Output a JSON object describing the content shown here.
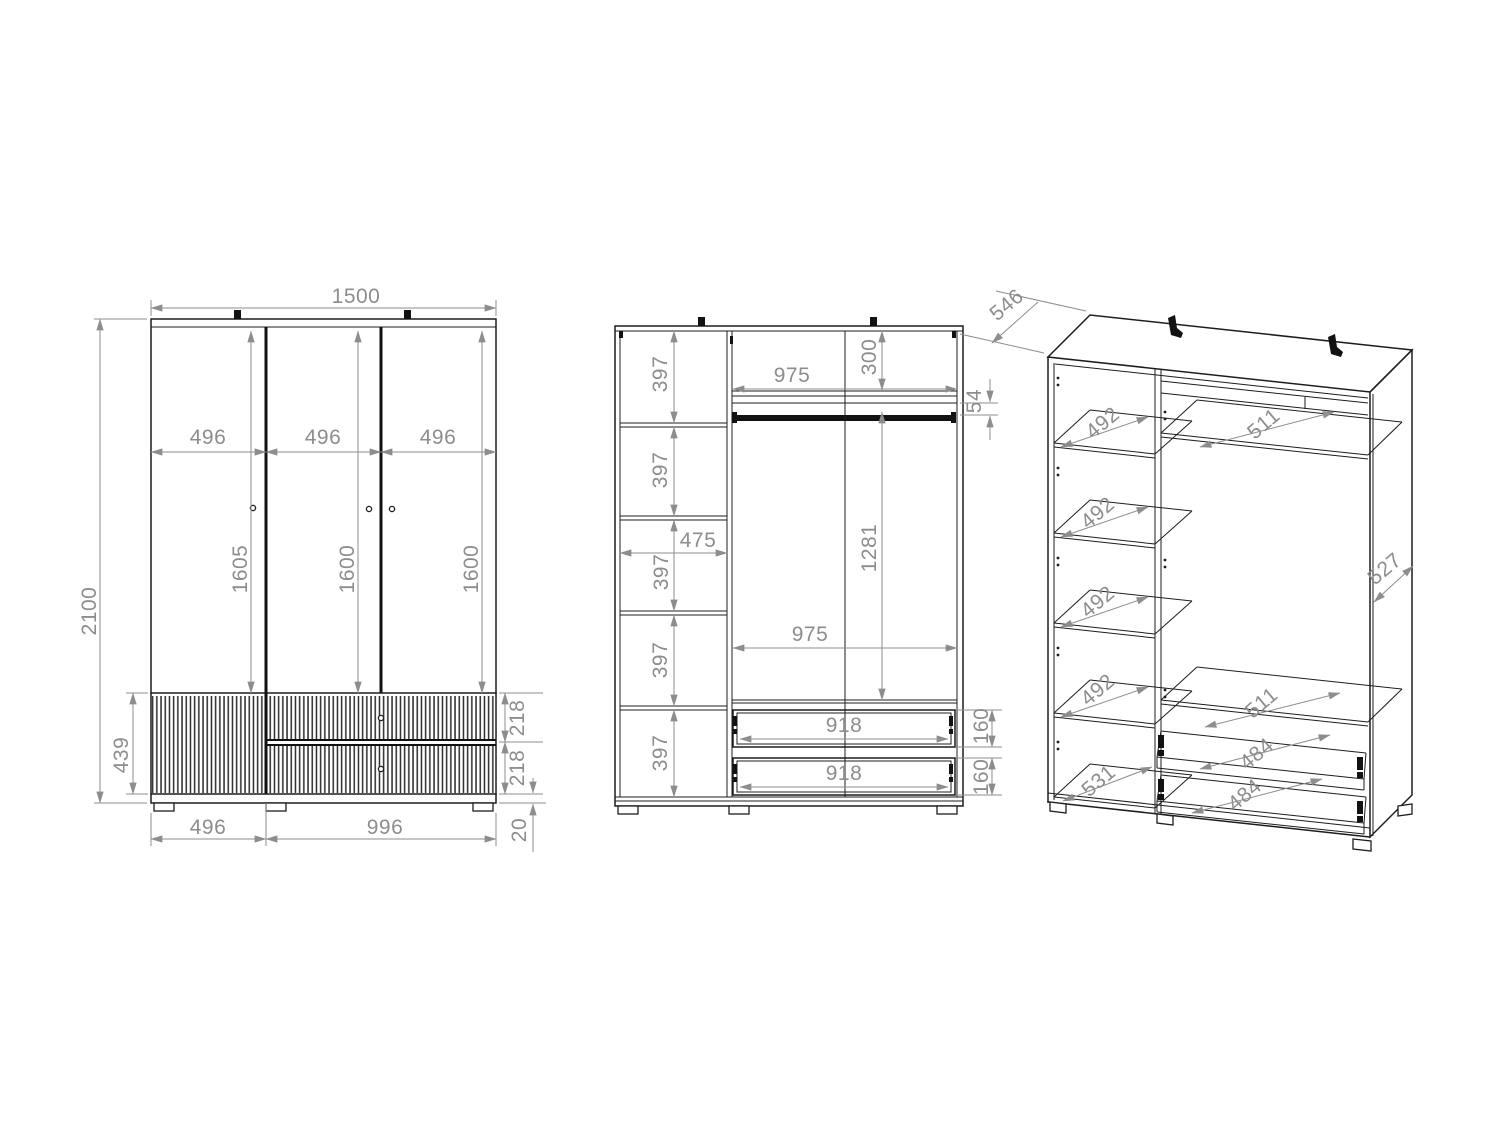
{
  "drawing_title": "Wardrobe three-view technical drawing",
  "colors": {
    "outline": "#1d1d1d",
    "dimension": "#8d8d8d"
  },
  "front_view": {
    "overall_width": "1500",
    "overall_height": "2100",
    "door_widths": [
      "496",
      "496",
      "496"
    ],
    "door_heights": [
      "1605",
      "1600",
      "1600"
    ],
    "base_height": "439",
    "drawer_front_heights": [
      "218",
      "218"
    ],
    "plinth_height": "20",
    "base_section_widths": [
      "496",
      "996"
    ]
  },
  "section_view": {
    "shelf_spacings": [
      "397",
      "397",
      "397",
      "397",
      "397"
    ],
    "column_inner_width": "475",
    "inner_width_upper": "975",
    "inner_width_lower": "975",
    "top_compartment_height": "300",
    "rail_clearance": "54",
    "hanging_space_height": "1281",
    "drawer_inner_widths": [
      "918",
      "918"
    ],
    "drawer_inner_heights": [
      "160",
      "160"
    ]
  },
  "perspective_view": {
    "overall_depth": "546",
    "side_panel_depth": "527",
    "shelf_depths": [
      "492",
      "492",
      "492",
      "492"
    ],
    "bottom_shelf_depth": "531",
    "upper_shelf_depths": [
      "511",
      "511"
    ],
    "drawer_depths": [
      "484",
      "484"
    ]
  }
}
